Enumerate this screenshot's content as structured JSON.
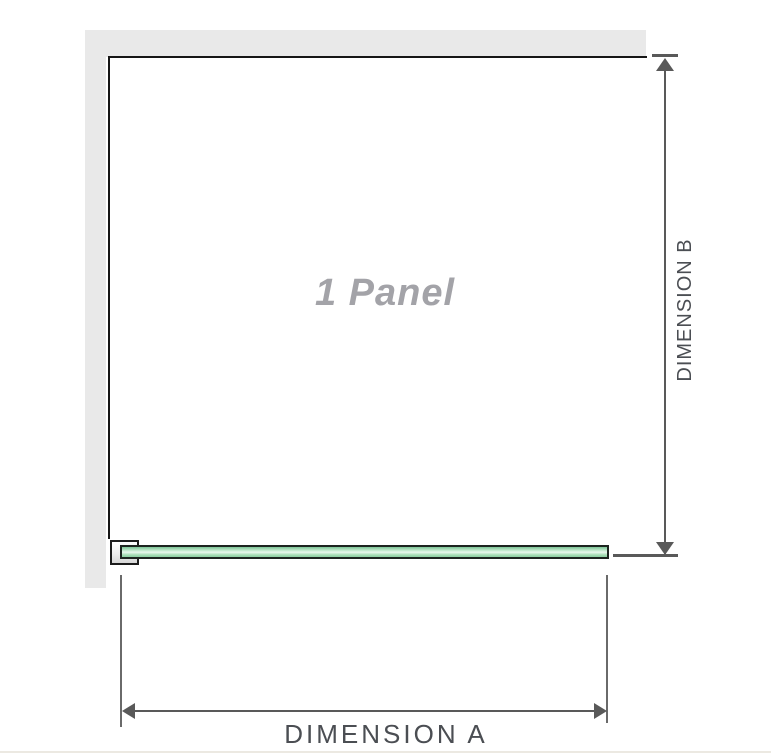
{
  "diagram": {
    "panel_label": "1 Panel",
    "dimension_a_label": "DIMENSION A",
    "dimension_b_label": "DIMENSION B",
    "colors": {
      "wall": "#e9e9e9",
      "panel_outline": "#161616",
      "glass_green_dark": "#7cc496",
      "glass_green_mid": "#a5dcb4",
      "glass_green_light": "#e9f8ed",
      "glass_border": "#1d241f",
      "dimension_line": "#595959",
      "dimension_text": "#4b4e53",
      "panel_label_text": "#a3a3a8",
      "bottom_rule": "#ece9e2"
    }
  }
}
